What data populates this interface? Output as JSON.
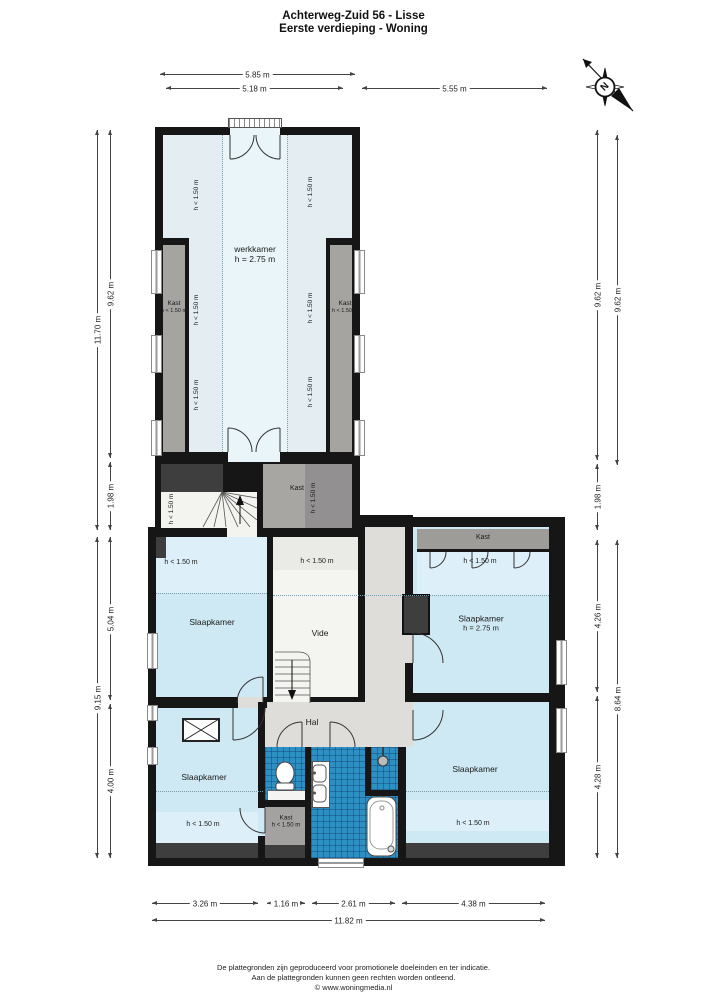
{
  "title": {
    "line1": "Achterweg-Zuid 56 - Lisse",
    "line2": "Eerste verdieping - Woning"
  },
  "compass": {
    "north_label": "N"
  },
  "labels": {
    "h150": "h < 1.50 m"
  },
  "rooms": {
    "werkkamer": {
      "name": "werkkamer",
      "height": "h = 2.75 m"
    },
    "kast_left": {
      "name": "Kast",
      "height": "h < 1.50 m"
    },
    "kast_right": {
      "name": "Kast",
      "height": "h < 1.50 m"
    },
    "kast_landing": {
      "name": "Kast",
      "height": "h < 1.50 m"
    },
    "slaapkamer_links": {
      "name": "Slaapkamer",
      "low_zone": "h < 1.50 m"
    },
    "vide": {
      "name": "Vide",
      "low_zone": "h < 1.50 m"
    },
    "slaapkamer_rechtsboven": {
      "name": "Slaapkamer",
      "height": "h = 2.75 m",
      "low_zone": "h < 1.50 m",
      "kast": "Kast"
    },
    "hal": {
      "name": "Hal"
    },
    "slaapkamer_linksonder": {
      "name": "Slaapkamer",
      "low_zone": "h < 1.50 m"
    },
    "kast_badkamer": {
      "name": "Kast",
      "height": "h < 1.50 m"
    },
    "slaapkamer_rechtsonder": {
      "name": "Slaapkamer",
      "low_zone": "h < 1.50 m"
    }
  },
  "dimensions": {
    "top_outer": "5.85 m",
    "top_inner": "5.18 m",
    "top_right": "5.55 m",
    "left_outer_upper": "11.70 m",
    "left_inner_upper": "9.62 m",
    "left_inner_landing": "1.98 m",
    "left_outer_lower": "9.15 m",
    "left_inner_lower_top": "5.04 m",
    "left_inner_lower_bottom": "4.00 m",
    "right_inner_upper": "9.62 m",
    "right_outer_upper": "9.62 m",
    "right_inner_landing": "1.98 m",
    "right_inner_lower_top": "4.26 m",
    "right_inner_lower_bottom": "4.28 m",
    "right_outer_lower": "8.64 m",
    "bottom_1": "3.26 m",
    "bottom_2": "1.16 m",
    "bottom_3": "2.61 m",
    "bottom_4": "4.38 m",
    "bottom_total": "11.82 m"
  },
  "footer": {
    "line1": "De plattegronden zijn geproduceerd voor promotionele doeleinden en ter indicatie.",
    "line2": "Aan de plattegronden kunnen geen rechten worden ontleend.",
    "line3": "© www.woningmedia.nl"
  }
}
